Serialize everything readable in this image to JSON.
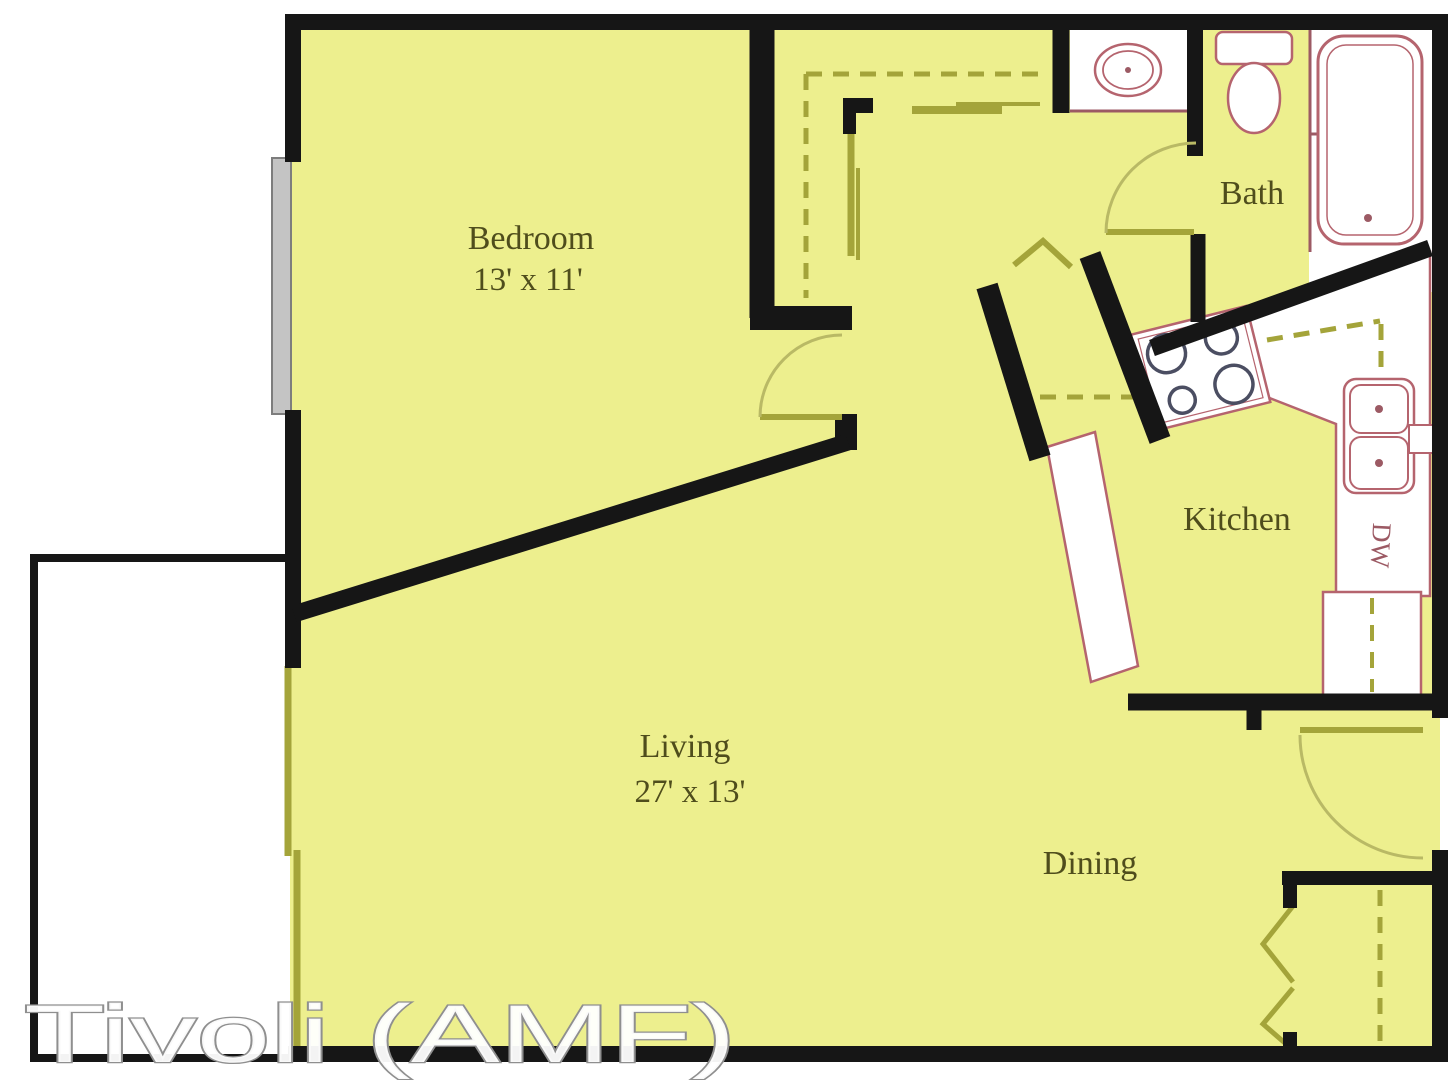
{
  "watermark": "Tivoli (AMF)",
  "rooms": {
    "bedroom": {
      "name": "Bedroom",
      "dims": "13' x 11'"
    },
    "bath": {
      "name": "Bath"
    },
    "kitchen": {
      "name": "Kitchen"
    },
    "living": {
      "name": "Living",
      "dims": "27' x 13'"
    },
    "dining": {
      "name": "Dining"
    }
  },
  "fixtures": {
    "dishwasher_label": "DW",
    "icons": [
      "bathtub-icon",
      "toilet-icon",
      "vanity-sink-icon",
      "stove-icon",
      "kitchen-sink-icon",
      "refrigerator-icon",
      "dishwasher-icon",
      "window-icon",
      "sliding-door-icon",
      "door-swing-icon",
      "bifold-door-icon",
      "closet-rod-icon",
      "breakfast-bar-icon"
    ]
  },
  "colors": {
    "floor": "#edef8e",
    "wall": "#161616",
    "fixture": "#b5646e",
    "counter_edge": "#9c5a64",
    "accent": "#a4a43a",
    "accent_light": "#b9b965",
    "window_gray": "#c4c4c4",
    "burner": "#4b4e62",
    "label": "#4f4d1c",
    "watermark_fill": "#ffffff",
    "watermark_stroke": "#8f8f8f"
  }
}
